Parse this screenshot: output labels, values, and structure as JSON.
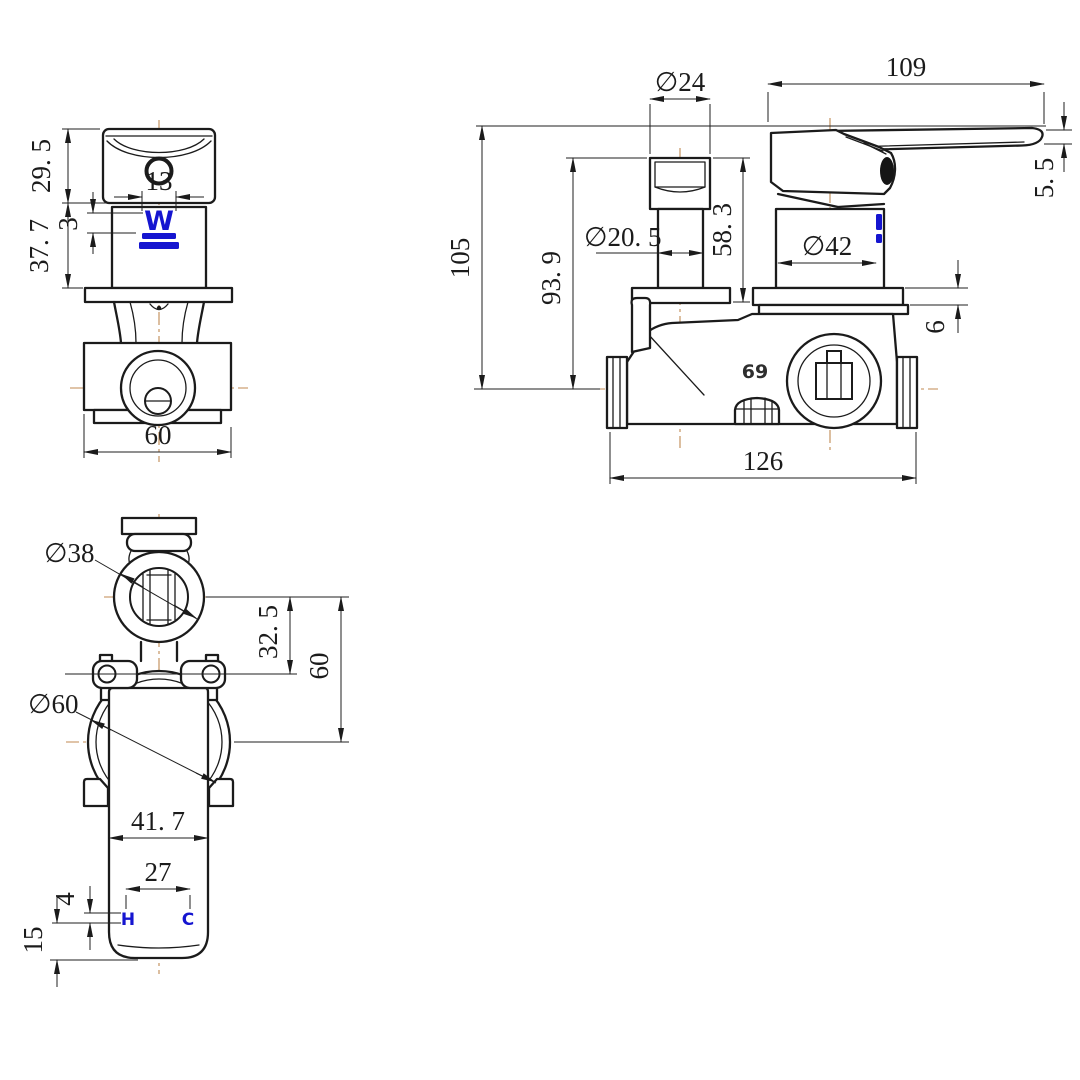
{
  "colors": {
    "line": "#1b1b1b",
    "centerline": "#c08a52",
    "brand_blue": "#1515d0",
    "background": "#ffffff"
  },
  "front_view": {
    "dims": {
      "cap_height": "29. 5",
      "body_height": "37. 7",
      "logo_width": "13",
      "logo_offset": "3",
      "base_width": "60"
    },
    "logo_letter": "W"
  },
  "side_view": {
    "dims": {
      "handle_length": "109",
      "knob_diameter": "∅24",
      "handle_thickness": "5. 5",
      "overall_height": "105",
      "knob_height": "93. 9",
      "cartridge_height": "58. 3",
      "stem_diameter": "∅20. 5",
      "body_diameter": "∅42",
      "plate_thickness": "6",
      "body_width": "126"
    },
    "casting_mark": "69"
  },
  "top_view": {
    "dims": {
      "knob_diameter": "∅38",
      "knob_offset": "32. 5",
      "axis_spacing": "60",
      "body_diameter": "∅60",
      "lever_width": "41. 7",
      "hc_spacing": "27",
      "marking_height": "4",
      "marking_offset": "15"
    },
    "hot_label": "H",
    "cold_label": "C"
  }
}
